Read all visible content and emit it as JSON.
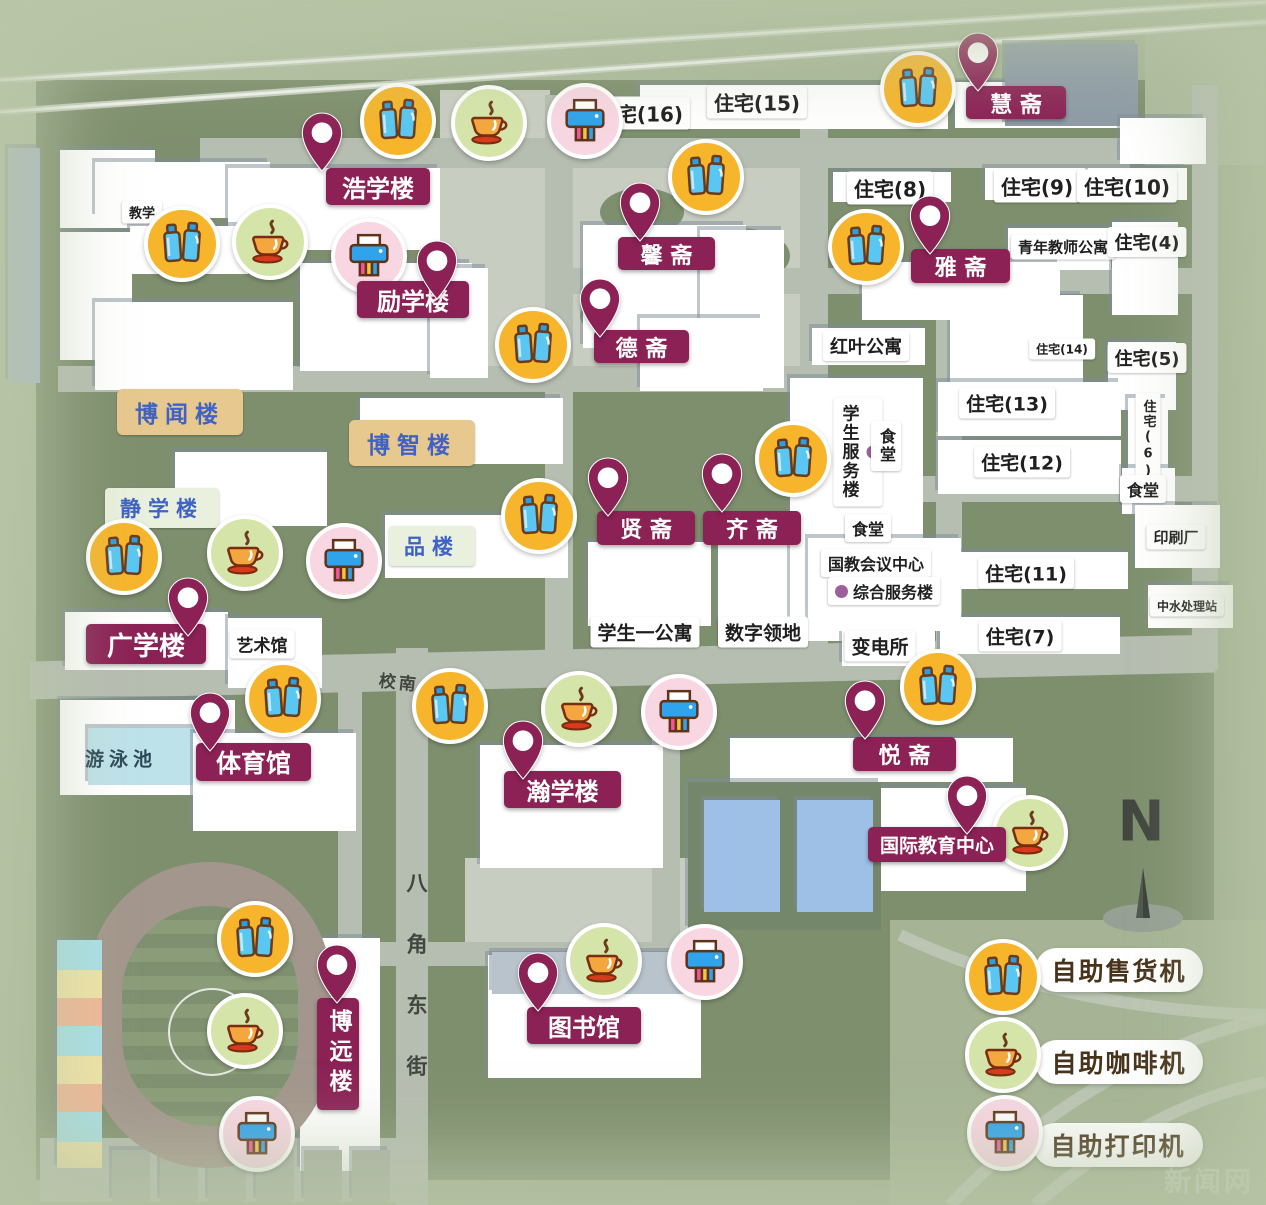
{
  "legend": {
    "items": [
      {
        "type": "vending",
        "label": "自助售货机"
      },
      {
        "type": "coffee",
        "label": "自助咖啡机"
      },
      {
        "type": "printer",
        "label": "自助打印机"
      }
    ]
  },
  "compass": {
    "label": "N"
  },
  "watermark": {
    "text": "新闻网"
  },
  "streets": [
    {
      "label": "校南",
      "x": 399,
      "y": 681,
      "rotate": 6,
      "fs": 17,
      "vertical": false
    },
    {
      "label": "八角东街",
      "x": 416,
      "y": 872,
      "rotate": 0,
      "fs": 21,
      "vertical": true
    }
  ],
  "pois": [
    {
      "label": "浩学楼",
      "pin": [
        322,
        172
      ],
      "b": [
        326,
        168,
        104,
        37
      ],
      "fs": 24,
      "vertical": false
    },
    {
      "label": "励学楼",
      "pin": [
        437,
        300
      ],
      "b": [
        357,
        281,
        112,
        37
      ],
      "fs": 24,
      "vertical": false
    },
    {
      "label": "馨 斋",
      "pin": [
        640,
        242
      ],
      "b": [
        618,
        237,
        97,
        33
      ],
      "fs": 22,
      "vertical": false
    },
    {
      "label": "德 斋",
      "pin": [
        600,
        338
      ],
      "b": [
        594,
        330,
        95,
        33
      ],
      "fs": 22,
      "vertical": false
    },
    {
      "label": "雅 斋",
      "pin": [
        930,
        255
      ],
      "b": [
        911,
        249,
        99,
        34
      ],
      "fs": 22,
      "vertical": false
    },
    {
      "label": "慧 斋",
      "pin": [
        978,
        92
      ],
      "b": [
        966,
        86,
        100,
        33
      ],
      "fs": 22,
      "vertical": false
    },
    {
      "label": "贤 斋",
      "pin": [
        608,
        517
      ],
      "b": [
        597,
        511,
        98,
        34
      ],
      "fs": 22,
      "vertical": false
    },
    {
      "label": "齐 斋",
      "pin": [
        722,
        513
      ],
      "b": [
        703,
        511,
        98,
        34
      ],
      "fs": 22,
      "vertical": false
    },
    {
      "label": "广学楼",
      "pin": [
        188,
        637
      ],
      "b": [
        86,
        624,
        120,
        40
      ],
      "fs": 26,
      "vertical": false
    },
    {
      "label": "体育馆",
      "pin": [
        210,
        752
      ],
      "b": [
        196,
        743,
        115,
        38
      ],
      "fs": 25,
      "vertical": false
    },
    {
      "label": "瀚学楼",
      "pin": [
        523,
        780
      ],
      "b": [
        504,
        771,
        117,
        37
      ],
      "fs": 24,
      "vertical": false
    },
    {
      "label": "悦 斋",
      "pin": [
        865,
        740
      ],
      "b": [
        853,
        737,
        103,
        34
      ],
      "fs": 22,
      "vertical": false
    },
    {
      "label": "国际教育中心",
      "pin": [
        967,
        835
      ],
      "b": [
        868,
        827,
        138,
        35
      ],
      "fs": 19,
      "vertical": false
    },
    {
      "label": "图书馆",
      "pin": [
        538,
        1012
      ],
      "b": [
        527,
        1007,
        114,
        37
      ],
      "fs": 24,
      "vertical": false
    },
    {
      "label": "博远楼",
      "pin": [
        337,
        1004
      ],
      "b": [
        317,
        998,
        42,
        112
      ],
      "fs": 23,
      "vertical": true
    }
  ],
  "amenities": [
    {
      "type": "vending",
      "x": 398,
      "y": 121
    },
    {
      "type": "coffee",
      "x": 489,
      "y": 123
    },
    {
      "type": "printer",
      "x": 585,
      "y": 121
    },
    {
      "type": "vending",
      "x": 918,
      "y": 89
    },
    {
      "type": "vending",
      "x": 706,
      "y": 177
    },
    {
      "type": "vending",
      "x": 182,
      "y": 244
    },
    {
      "type": "coffee",
      "x": 270,
      "y": 242
    },
    {
      "type": "printer",
      "x": 369,
      "y": 256
    },
    {
      "type": "vending",
      "x": 866,
      "y": 247
    },
    {
      "type": "vending",
      "x": 533,
      "y": 345
    },
    {
      "type": "vending",
      "x": 793,
      "y": 459
    },
    {
      "type": "vending",
      "x": 539,
      "y": 516
    },
    {
      "type": "vending",
      "x": 124,
      "y": 557
    },
    {
      "type": "coffee",
      "x": 245,
      "y": 553
    },
    {
      "type": "printer",
      "x": 344,
      "y": 561
    },
    {
      "type": "vending",
      "x": 283,
      "y": 699
    },
    {
      "type": "vending",
      "x": 450,
      "y": 706
    },
    {
      "type": "coffee",
      "x": 579,
      "y": 709
    },
    {
      "type": "printer",
      "x": 679,
      "y": 712
    },
    {
      "type": "vending",
      "x": 938,
      "y": 687
    },
    {
      "type": "coffee",
      "x": 1030,
      "y": 833
    },
    {
      "type": "vending",
      "x": 255,
      "y": 939
    },
    {
      "type": "coffee",
      "x": 245,
      "y": 1031
    },
    {
      "type": "printer",
      "x": 257,
      "y": 1134
    },
    {
      "type": "coffee",
      "x": 604,
      "y": 961
    },
    {
      "type": "printer",
      "x": 705,
      "y": 962
    }
  ],
  "plaques": [
    {
      "label": "住宅(16)",
      "x": 640,
      "y": 113,
      "fs": 20,
      "style": "white"
    },
    {
      "label": "住宅(15)",
      "x": 757,
      "y": 102,
      "fs": 20,
      "style": "white"
    },
    {
      "label": "住宅(8)",
      "x": 890,
      "y": 188,
      "fs": 20,
      "style": "white"
    },
    {
      "label": "住宅(9)",
      "x": 1037,
      "y": 186,
      "fs": 20,
      "style": "white"
    },
    {
      "label": "住宅(10)",
      "x": 1127,
      "y": 186,
      "fs": 20,
      "style": "white"
    },
    {
      "label": "青年教师公寓",
      "x": 1063,
      "y": 247,
      "fs": 15,
      "style": "white"
    },
    {
      "label": "住宅(4)",
      "x": 1147,
      "y": 242,
      "fs": 18,
      "style": "white"
    },
    {
      "label": "住宅(14)",
      "x": 1062,
      "y": 349,
      "fs": 12,
      "style": "white"
    },
    {
      "label": "住宅(5)",
      "x": 1147,
      "y": 358,
      "fs": 18,
      "style": "white"
    },
    {
      "label": "住宅(13)",
      "x": 1007,
      "y": 403,
      "fs": 19,
      "style": "white"
    },
    {
      "label": "住宅(12)",
      "x": 1022,
      "y": 462,
      "fs": 19,
      "style": "white"
    },
    {
      "label": "住宅(6)",
      "x": 1148,
      "y": 440,
      "fs": 13,
      "style": "white",
      "vertical": true
    },
    {
      "label": "食堂",
      "x": 1143,
      "y": 489,
      "fs": 16,
      "style": "white"
    },
    {
      "label": "红叶公寓",
      "x": 866,
      "y": 346,
      "fs": 18,
      "style": "white"
    },
    {
      "label": "学生服务楼",
      "x": 858,
      "y": 452,
      "fs": 17,
      "style": "white",
      "vertical": true,
      "dot": true
    },
    {
      "label": "食堂",
      "x": 886,
      "y": 446,
      "fs": 16,
      "style": "white",
      "vertical": true
    },
    {
      "label": "食堂",
      "x": 868,
      "y": 528,
      "fs": 16,
      "style": "white"
    },
    {
      "label": "国教会议中心",
      "x": 876,
      "y": 563,
      "fs": 16,
      "style": "white"
    },
    {
      "label": "综合服务楼",
      "x": 884,
      "y": 591,
      "fs": 16,
      "style": "white",
      "dot": true
    },
    {
      "label": "学生一公寓",
      "x": 645,
      "y": 632,
      "fs": 19,
      "style": "white"
    },
    {
      "label": "数字领地",
      "x": 763,
      "y": 632,
      "fs": 19,
      "style": "white"
    },
    {
      "label": "变电所",
      "x": 880,
      "y": 646,
      "fs": 19,
      "style": "white"
    },
    {
      "label": "住宅(11)",
      "x": 1026,
      "y": 573,
      "fs": 19,
      "style": "white"
    },
    {
      "label": "住宅(7)",
      "x": 1020,
      "y": 636,
      "fs": 19,
      "style": "white"
    },
    {
      "label": "印刷厂",
      "x": 1176,
      "y": 537,
      "fs": 15,
      "style": "white"
    },
    {
      "label": "中水处理站",
      "x": 1187,
      "y": 606,
      "fs": 12,
      "style": "white"
    },
    {
      "label": "艺术馆",
      "x": 262,
      "y": 644,
      "fs": 17,
      "style": "white"
    },
    {
      "label": "教学",
      "x": 142,
      "y": 212,
      "fs": 13,
      "style": "white"
    },
    {
      "label": "游泳池",
      "x": 121,
      "y": 758,
      "fs": 19,
      "style": "pool"
    },
    {
      "label": "博闻楼",
      "x": 180,
      "y": 412,
      "fs": 23,
      "style": "tan"
    },
    {
      "label": "博智楼",
      "x": 412,
      "y": 443,
      "fs": 23,
      "style": "tan"
    },
    {
      "label": "静学楼",
      "x": 162,
      "y": 508,
      "fs": 21,
      "style": "green"
    },
    {
      "label": "品楼",
      "x": 432,
      "y": 546,
      "fs": 21,
      "style": "green"
    }
  ]
}
